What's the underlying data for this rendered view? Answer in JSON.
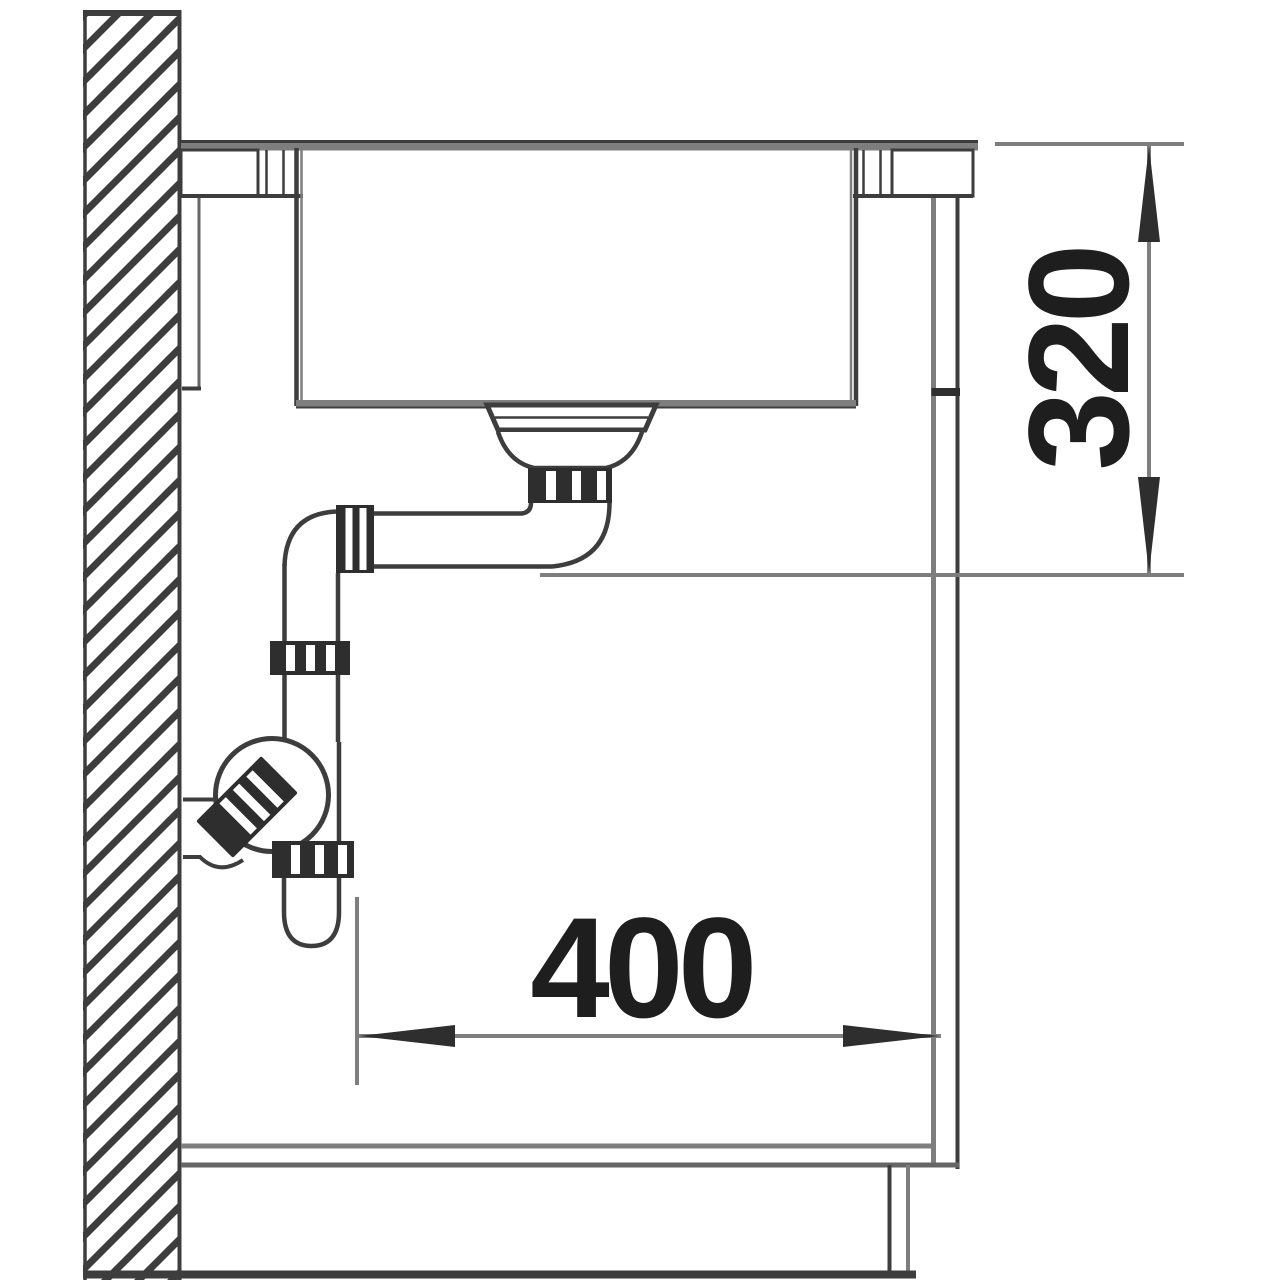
{
  "document": {
    "title": "Sink installation side cross-section technical drawing"
  },
  "dimensions": {
    "height": {
      "label": "320"
    },
    "depth": {
      "label": "400"
    }
  },
  "components": {
    "wall": "hatched-wall-section",
    "countertop": "countertop-with-sink-cutout",
    "sink": "undermount-sink-bowl",
    "drain": "strainer-drain-assembly",
    "trap": "bottle-trap-siphon",
    "cabinet": "base-cabinet-with-plinth"
  },
  "colors": {
    "background": "#ffffff",
    "line_dark": "#3d3d3d",
    "line_medium": "#666666",
    "line_gray": "#7e7e7e",
    "fitting_dark": "#2e2e2e",
    "text": "#1e1e1e"
  }
}
